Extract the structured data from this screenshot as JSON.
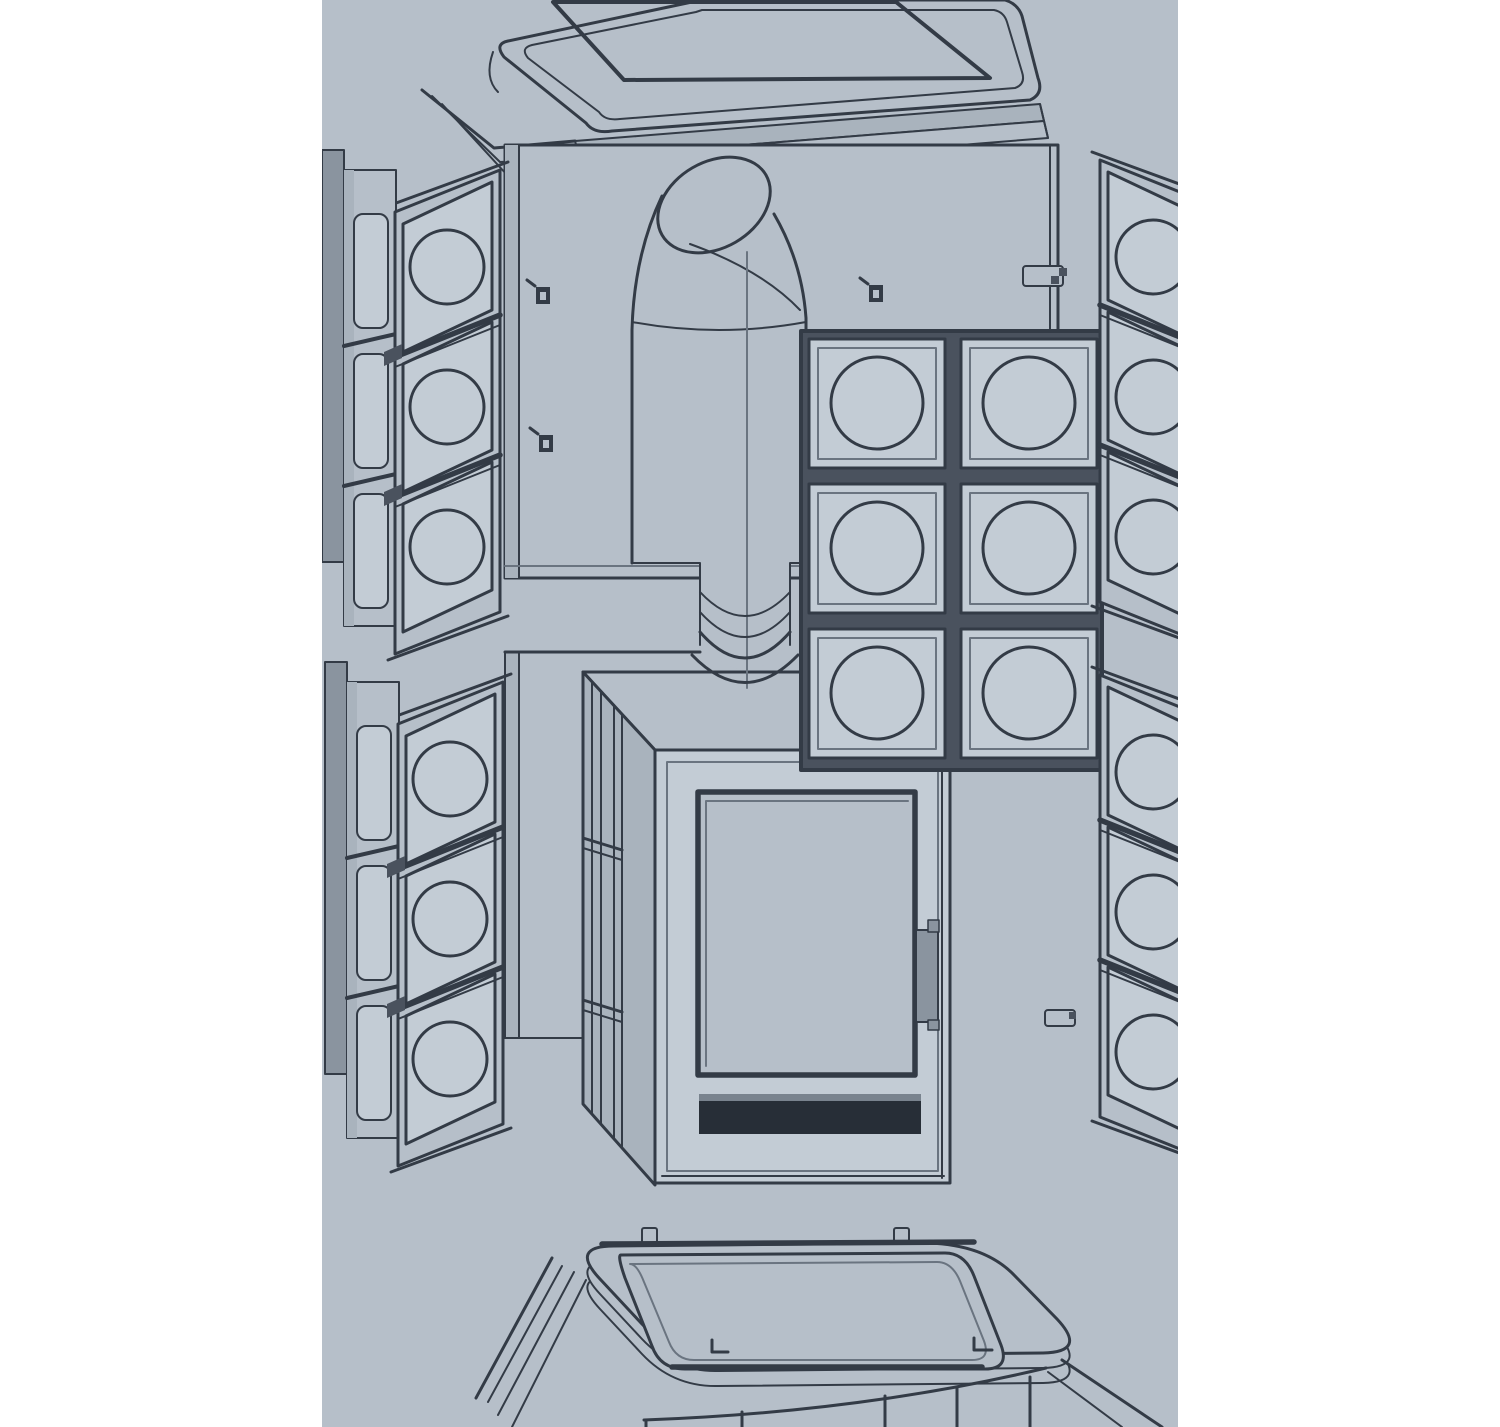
{
  "page": {
    "kind": "technical-exploded-diagram",
    "text_visible": ""
  },
  "palette": {
    "margin": "#ffffff",
    "canvas_bg": "#b6bfc9",
    "line": "#333b46",
    "line_soft": "#6a7480",
    "mid": "#8a949f",
    "light_face": "#a9b3bd",
    "tile_face": "#c3ccd5",
    "dark_fill": "#4a525e",
    "slot": "#272e37",
    "bevel": "#79838e",
    "grate_dark": "#39414c",
    "grate_hi": "#828c97"
  },
  "diagram": {
    "subject": "tiled stove exploded assembly view",
    "projection": "isometric line drawing",
    "parts": [
      {
        "id": "top-cover",
        "desc": "rounded top plate with woven grille insert"
      },
      {
        "id": "rear-upper-panel",
        "desc": "upper rear panel with three screw marks"
      },
      {
        "id": "flue-elbow-pipe",
        "desc": "elbow stove pipe dropping to firebox collar"
      },
      {
        "id": "rear-tile-grid",
        "desc": "grid of square tiles with circular medallions",
        "rows": 3,
        "columns": 2
      },
      {
        "id": "left-upper-tile-column",
        "desc": "corner tile column",
        "tiles": 3
      },
      {
        "id": "left-lower-tile-column",
        "desc": "corner tile column",
        "tiles": 3
      },
      {
        "id": "right-upper-tile-column",
        "desc": "corner tile column, cropped at edge",
        "tiles": 3
      },
      {
        "id": "right-lower-tile-column",
        "desc": "corner tile column, cropped at edge",
        "tiles": 3
      },
      {
        "id": "rear-lower-panel",
        "desc": "lower rear panel"
      },
      {
        "id": "firebox",
        "desc": "stove body with glass door, handle and air slot"
      },
      {
        "id": "base-plinth",
        "desc": "base with rounded top frame, two pegs and tiled skirt"
      }
    ],
    "screw_marks": 3,
    "base_pegs": 2,
    "grid_tile_count": 6,
    "column_tile_count": 12
  }
}
